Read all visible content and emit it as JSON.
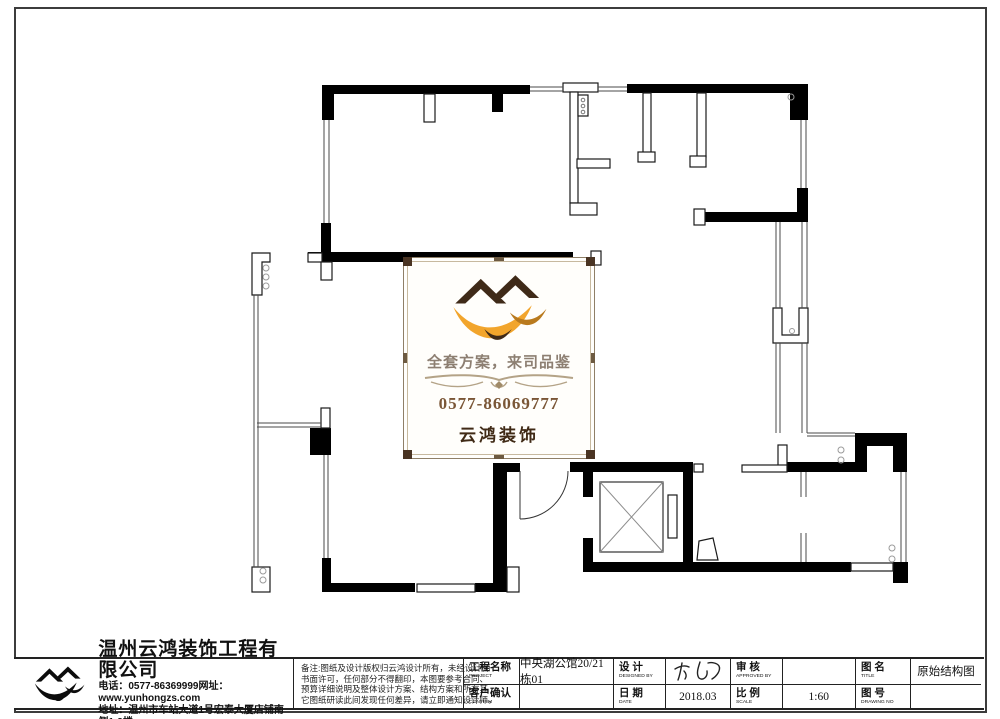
{
  "drawing": {
    "wall_color": "#000000",
    "line_color": "#3f3f3f",
    "logo_panel": {
      "slogan": "全套方案，来司品鉴",
      "phone": "0577-86069777",
      "brand": "云鸿装饰",
      "accent_orange": "#f2a52c",
      "accent_dark_brown": "#3f2a18",
      "slogan_color": "#8d7f72",
      "phone_color": "#7a5636",
      "frame_color": "#8f7f67"
    }
  },
  "title_block": {
    "company": {
      "name": "温州云鸿装饰工程有限公司",
      "phone_line": "电话：0577-86369999网址：www.yunhongzs.com",
      "address_line": "地址：温州市车站大道1号宏泰大厦店铺南侧1-3楼"
    },
    "notes": {
      "line1": "备注:图纸及设计版权归云鸿设计所有，未经设计师",
      "line2": "书面许可，任何部分不得翻印，本图要参考合同、",
      "line3": "预算详细说明及整体设计方案、结构方案和所有其",
      "line4": "它图纸研读此间发现任何差异，请立即通知设计师。"
    },
    "fields": {
      "project_label": "工程名称",
      "project_label_en": "PROJECT",
      "project_value": "中央湖公馆20/21栋01",
      "confirm_label": "客户确认",
      "confirm_label_en": "CONFIRM",
      "confirm_value": "",
      "design_label": "设 计",
      "design_label_en": "DESIGNED BY",
      "date_label": "日 期",
      "date_label_en": "DATE",
      "date_value": "2018.03",
      "approve_label": "审 核",
      "approve_label_en": "APPROVED BY",
      "approve_value": "",
      "scale_label": "比 例",
      "scale_label_en": "SCALE",
      "scale_value": "1:60",
      "title_label": "图 名",
      "title_label_en": "TITLE",
      "title_value": "原始结构图",
      "no_label": "图 号",
      "no_label_en": "DRAWING NO",
      "no_value": ""
    }
  }
}
